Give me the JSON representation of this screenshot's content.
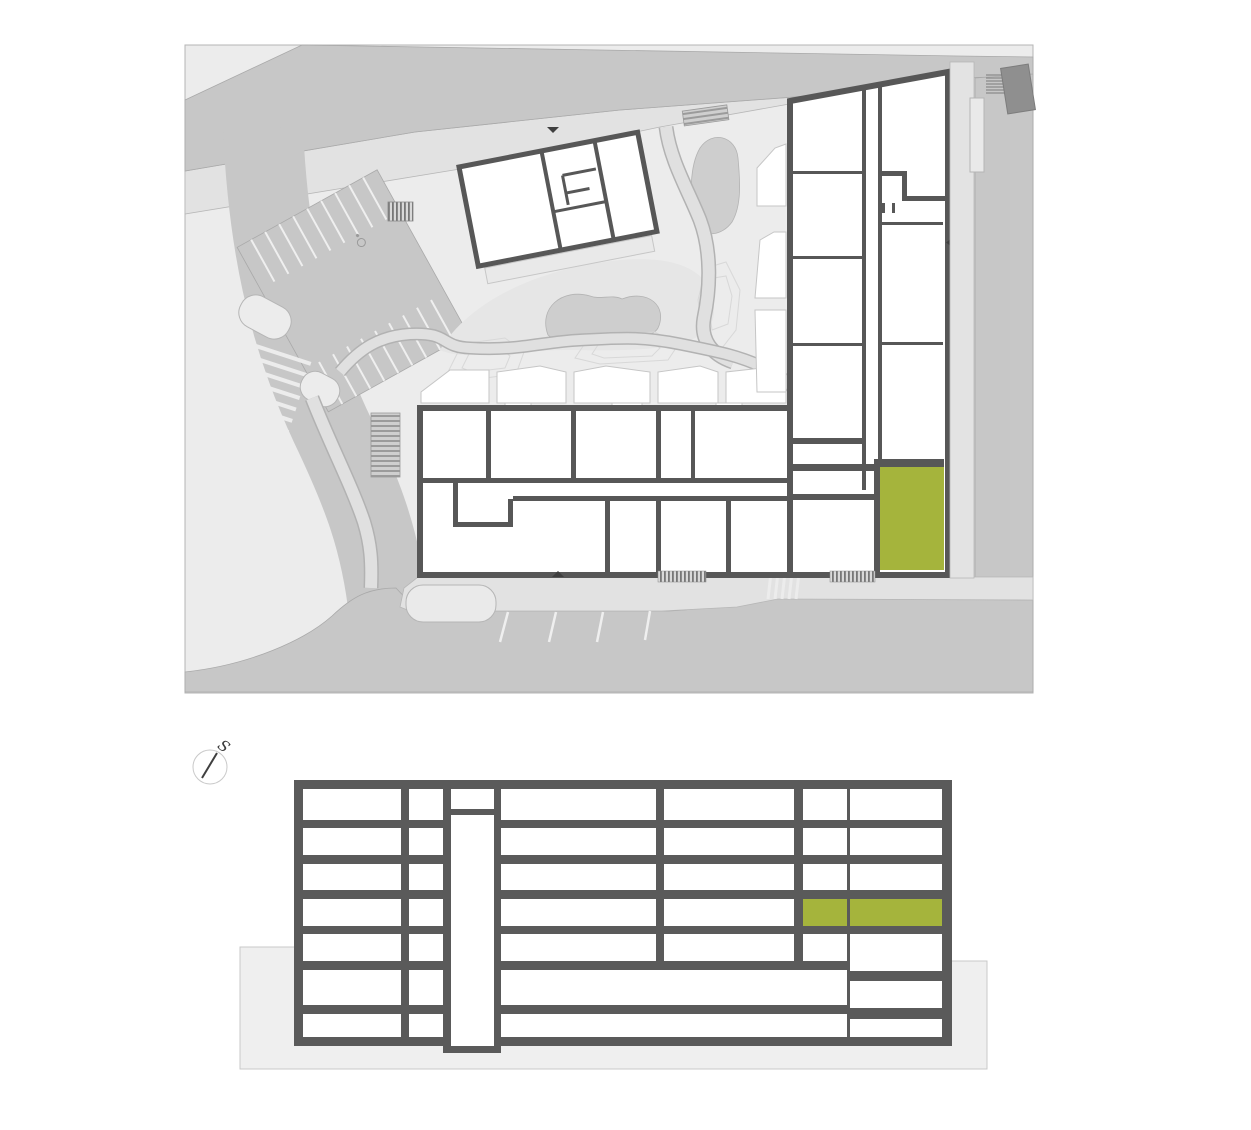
{
  "title": "residential-complex-locator",
  "compass": {
    "label": "S"
  },
  "colors": {
    "canvas": "#ececec",
    "road": "#c7c7c7",
    "road_edge": "#a9a9a9",
    "sidewalk": "#e2e2e2",
    "sidewalk_edge": "#b7b7b7",
    "wall": "#575757",
    "section_wall": "#5a5a5a",
    "unit_highlight": "#a5b43c",
    "ground": "#efefef",
    "ground_edge": "#c9c9c9",
    "landscape_mound": "#cecece",
    "neighbor_building": "#8f8f8f",
    "room_fill": "#ffffff"
  },
  "site_plan": {
    "highlighted_unit": {
      "x": 880,
      "y": 467,
      "w": 64,
      "h": 103
    }
  },
  "section": {
    "floors_count": 7,
    "highlighted_floor_index": 4,
    "cells": [
      {
        "x": 303,
        "y": 789,
        "w": 98,
        "h": 31
      },
      {
        "x": 303,
        "y": 828,
        "w": 98,
        "h": 27
      },
      {
        "x": 303,
        "y": 864,
        "w": 98,
        "h": 26
      },
      {
        "x": 303,
        "y": 899,
        "w": 98,
        "h": 27
      },
      {
        "x": 303,
        "y": 934,
        "w": 98,
        "h": 27
      },
      {
        "x": 303,
        "y": 970,
        "w": 98,
        "h": 35
      },
      {
        "x": 303,
        "y": 1014,
        "w": 98,
        "h": 23
      },
      {
        "x": 409,
        "y": 789,
        "w": 34,
        "h": 31
      },
      {
        "x": 409,
        "y": 828,
        "w": 34,
        "h": 27
      },
      {
        "x": 409,
        "y": 864,
        "w": 34,
        "h": 26
      },
      {
        "x": 409,
        "y": 899,
        "w": 34,
        "h": 27
      },
      {
        "x": 409,
        "y": 934,
        "w": 34,
        "h": 27
      },
      {
        "x": 409,
        "y": 970,
        "w": 34,
        "h": 35
      },
      {
        "x": 409,
        "y": 1014,
        "w": 34,
        "h": 23
      },
      {
        "x": 501,
        "y": 789,
        "w": 155,
        "h": 31
      },
      {
        "x": 501,
        "y": 828,
        "w": 155,
        "h": 27
      },
      {
        "x": 501,
        "y": 864,
        "w": 155,
        "h": 26
      },
      {
        "x": 501,
        "y": 899,
        "w": 155,
        "h": 27
      },
      {
        "x": 501,
        "y": 934,
        "w": 155,
        "h": 27
      },
      {
        "x": 664,
        "y": 789,
        "w": 130,
        "h": 31
      },
      {
        "x": 664,
        "y": 828,
        "w": 130,
        "h": 27
      },
      {
        "x": 664,
        "y": 864,
        "w": 130,
        "h": 26
      },
      {
        "x": 664,
        "y": 899,
        "w": 130,
        "h": 27
      },
      {
        "x": 664,
        "y": 934,
        "w": 130,
        "h": 27
      },
      {
        "x": 803,
        "y": 789,
        "w": 44,
        "h": 31
      },
      {
        "x": 803,
        "y": 828,
        "w": 44,
        "h": 27
      },
      {
        "x": 803,
        "y": 864,
        "w": 44,
        "h": 26
      },
      {
        "x": 803,
        "y": 899,
        "w": 44,
        "h": 27,
        "highlight": true
      },
      {
        "x": 803,
        "y": 934,
        "w": 44,
        "h": 27
      },
      {
        "x": 850,
        "y": 789,
        "w": 92,
        "h": 31
      },
      {
        "x": 850,
        "y": 828,
        "w": 92,
        "h": 27
      },
      {
        "x": 850,
        "y": 864,
        "w": 92,
        "h": 26
      },
      {
        "x": 850,
        "y": 899,
        "w": 92,
        "h": 27,
        "highlight": true
      },
      {
        "x": 850,
        "y": 934,
        "w": 92,
        "h": 37
      },
      {
        "x": 850,
        "y": 981,
        "w": 92,
        "h": 27
      },
      {
        "x": 850,
        "y": 1019,
        "w": 92,
        "h": 18
      },
      {
        "x": 501,
        "y": 970,
        "w": 346,
        "h": 35
      },
      {
        "x": 501,
        "y": 1014,
        "w": 346,
        "h": 23
      }
    ],
    "shaft_cells": [
      {
        "x": 451,
        "y": 789,
        "w": 43,
        "h": 20
      },
      {
        "x": 451,
        "y": 815,
        "w": 43,
        "h": 231
      }
    ]
  }
}
